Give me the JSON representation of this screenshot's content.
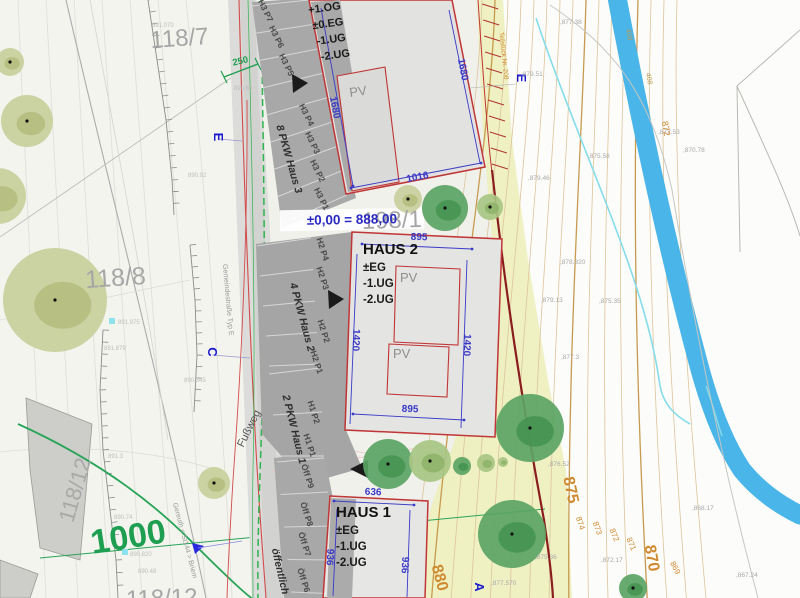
{
  "parcels": {
    "p118_7": "118/7",
    "p118_8": "118/8",
    "p118_12": "118/12",
    "p198_1": "198/1",
    "p1000": "1000",
    "p118_12b": "118/12"
  },
  "benchmark": "±0,00 = 888,00",
  "buildings": {
    "haus3": {
      "levels": [
        "+1.OG",
        "±0.EG",
        "-1.UG",
        "-2.UG"
      ],
      "pv": "PV",
      "dim_left": "1680",
      "dim_right": "1680",
      "dim_bottom": "1016"
    },
    "haus2": {
      "name": "HAUS 2",
      "levels": [
        "±EG",
        "-1.UG",
        "-2.UG"
      ],
      "pv_upper": "PV",
      "pv_lower": "PV",
      "dim_top": "895",
      "dim_left": "1420",
      "dim_right": "1420",
      "dim_bottom": "895"
    },
    "haus1": {
      "name": "HAUS 1",
      "levels": [
        "±EG",
        "-1.UG",
        "-2.UG"
      ],
      "dim_top": "636",
      "dim_left": "936",
      "dim_right": "936"
    }
  },
  "parking": {
    "caption_h3": "8 PKW Haus 3",
    "caption_h2": "4 PKW Haus 2",
    "caption_h1": "2 PKW Haus 1",
    "caption_public": "öffentlich",
    "stalls": [
      "H3 P7",
      "H3 P6",
      "H3 P5",
      "H3 P4",
      "H3 P3",
      "H3 P2",
      "H3 P1",
      "H2 P4",
      "H2 P3",
      "H2 P2",
      "H2 P1",
      "H1 P2",
      "H1 P1",
      "Öff P9",
      "Öff P8",
      "Öff P7",
      "Öff P6"
    ]
  },
  "paths": {
    "footpath": "Fußweg",
    "street": "Gemeindestraße Typ E",
    "route": "Gereuth < St144 > Briem",
    "edge_note": "Teilstück Nr. 208",
    "green_dim": "250"
  },
  "sections": {
    "e_left": "E",
    "e_right": "E",
    "c": "C",
    "a": "A"
  },
  "contour_labels": {
    "major": [
      "880",
      "875",
      "870"
    ],
    "minor": [
      "874",
      "873",
      "872",
      "871",
      "869",
      "872"
    ],
    "stream": [
      "408",
      "408"
    ]
  },
  "elevations_right": [
    ",877.38",
    ",879.51",
    ",875.58",
    ",879.46",
    ",870.78",
    ",872.53",
    ",878.320",
    ",879.13",
    ",875.35",
    ",877.3",
    ",876.52",
    ",868.17",
    ",872.17",
    ",875.36",
    ",877.570",
    ",867.24"
  ],
  "elevations_left": [
    "891.070",
    "890.60",
    "890.92",
    "891.975",
    "891.879",
    "890.345",
    "891.3",
    "890.74",
    "890.820",
    "890.48"
  ],
  "colors": {
    "contour_orange": "#cf8a30",
    "dimension_blue": "#3a3ac8",
    "boundary_red": "#c03535",
    "dark_red_wall": "#8a1d1d",
    "stream_blue": "#4ab5e8",
    "plan_green": "#28a458",
    "yellow_zone": "#edf0bd"
  }
}
